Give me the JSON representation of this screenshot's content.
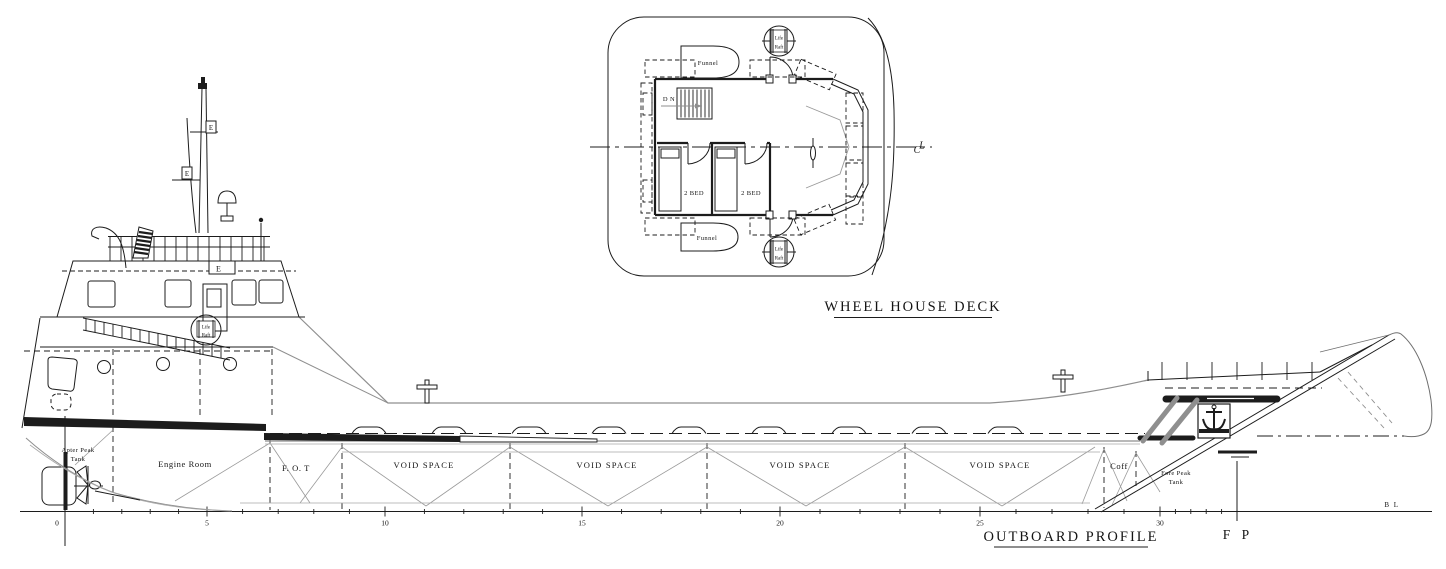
{
  "colors": {
    "ink": "#1c1c1c",
    "grey_line": "#8f8f8f",
    "background": "#ffffff"
  },
  "plan_view": {
    "title": "WHEEL HOUSE DECK",
    "funnel_top": "Funnel",
    "funnel_bottom": "Funnel",
    "stairs": "D N",
    "cabin_1": "2 BED",
    "cabin_2": "2 BED",
    "life_raft_top": {
      "line1": "Life",
      "line2": "Raft"
    },
    "life_raft_bottom": {
      "line1": "Life",
      "line2": "Raft"
    },
    "centerline": {
      "c": "C",
      "l": "L"
    }
  },
  "profile_view": {
    "title": "OUTBOARD PROFILE",
    "fp": "F P",
    "bl": "B L",
    "mast_flag_upper": "E",
    "mast_flag_lower": "E",
    "bridge_panel": "E",
    "life_raft_side": {
      "line1": "Life",
      "line2": "Raft"
    },
    "compartments": {
      "aft_peak": {
        "line1": "Apter Peak",
        "line2": "Tank"
      },
      "engine_room": "Engine Room",
      "fot": "F. O. T",
      "void_1": "VOID SPACE",
      "void_2": "VOID SPACE",
      "void_3": "VOID SPACE",
      "void_4": "VOID SPACE",
      "coff": "Coff",
      "fore_peak": {
        "line1": "Fore Peak",
        "line2": "Tank"
      }
    },
    "stations": [
      {
        "label": "0"
      },
      {
        "label": "5"
      },
      {
        "label": "10"
      },
      {
        "label": "15"
      },
      {
        "label": "20"
      },
      {
        "label": "25"
      },
      {
        "label": "30"
      }
    ]
  }
}
